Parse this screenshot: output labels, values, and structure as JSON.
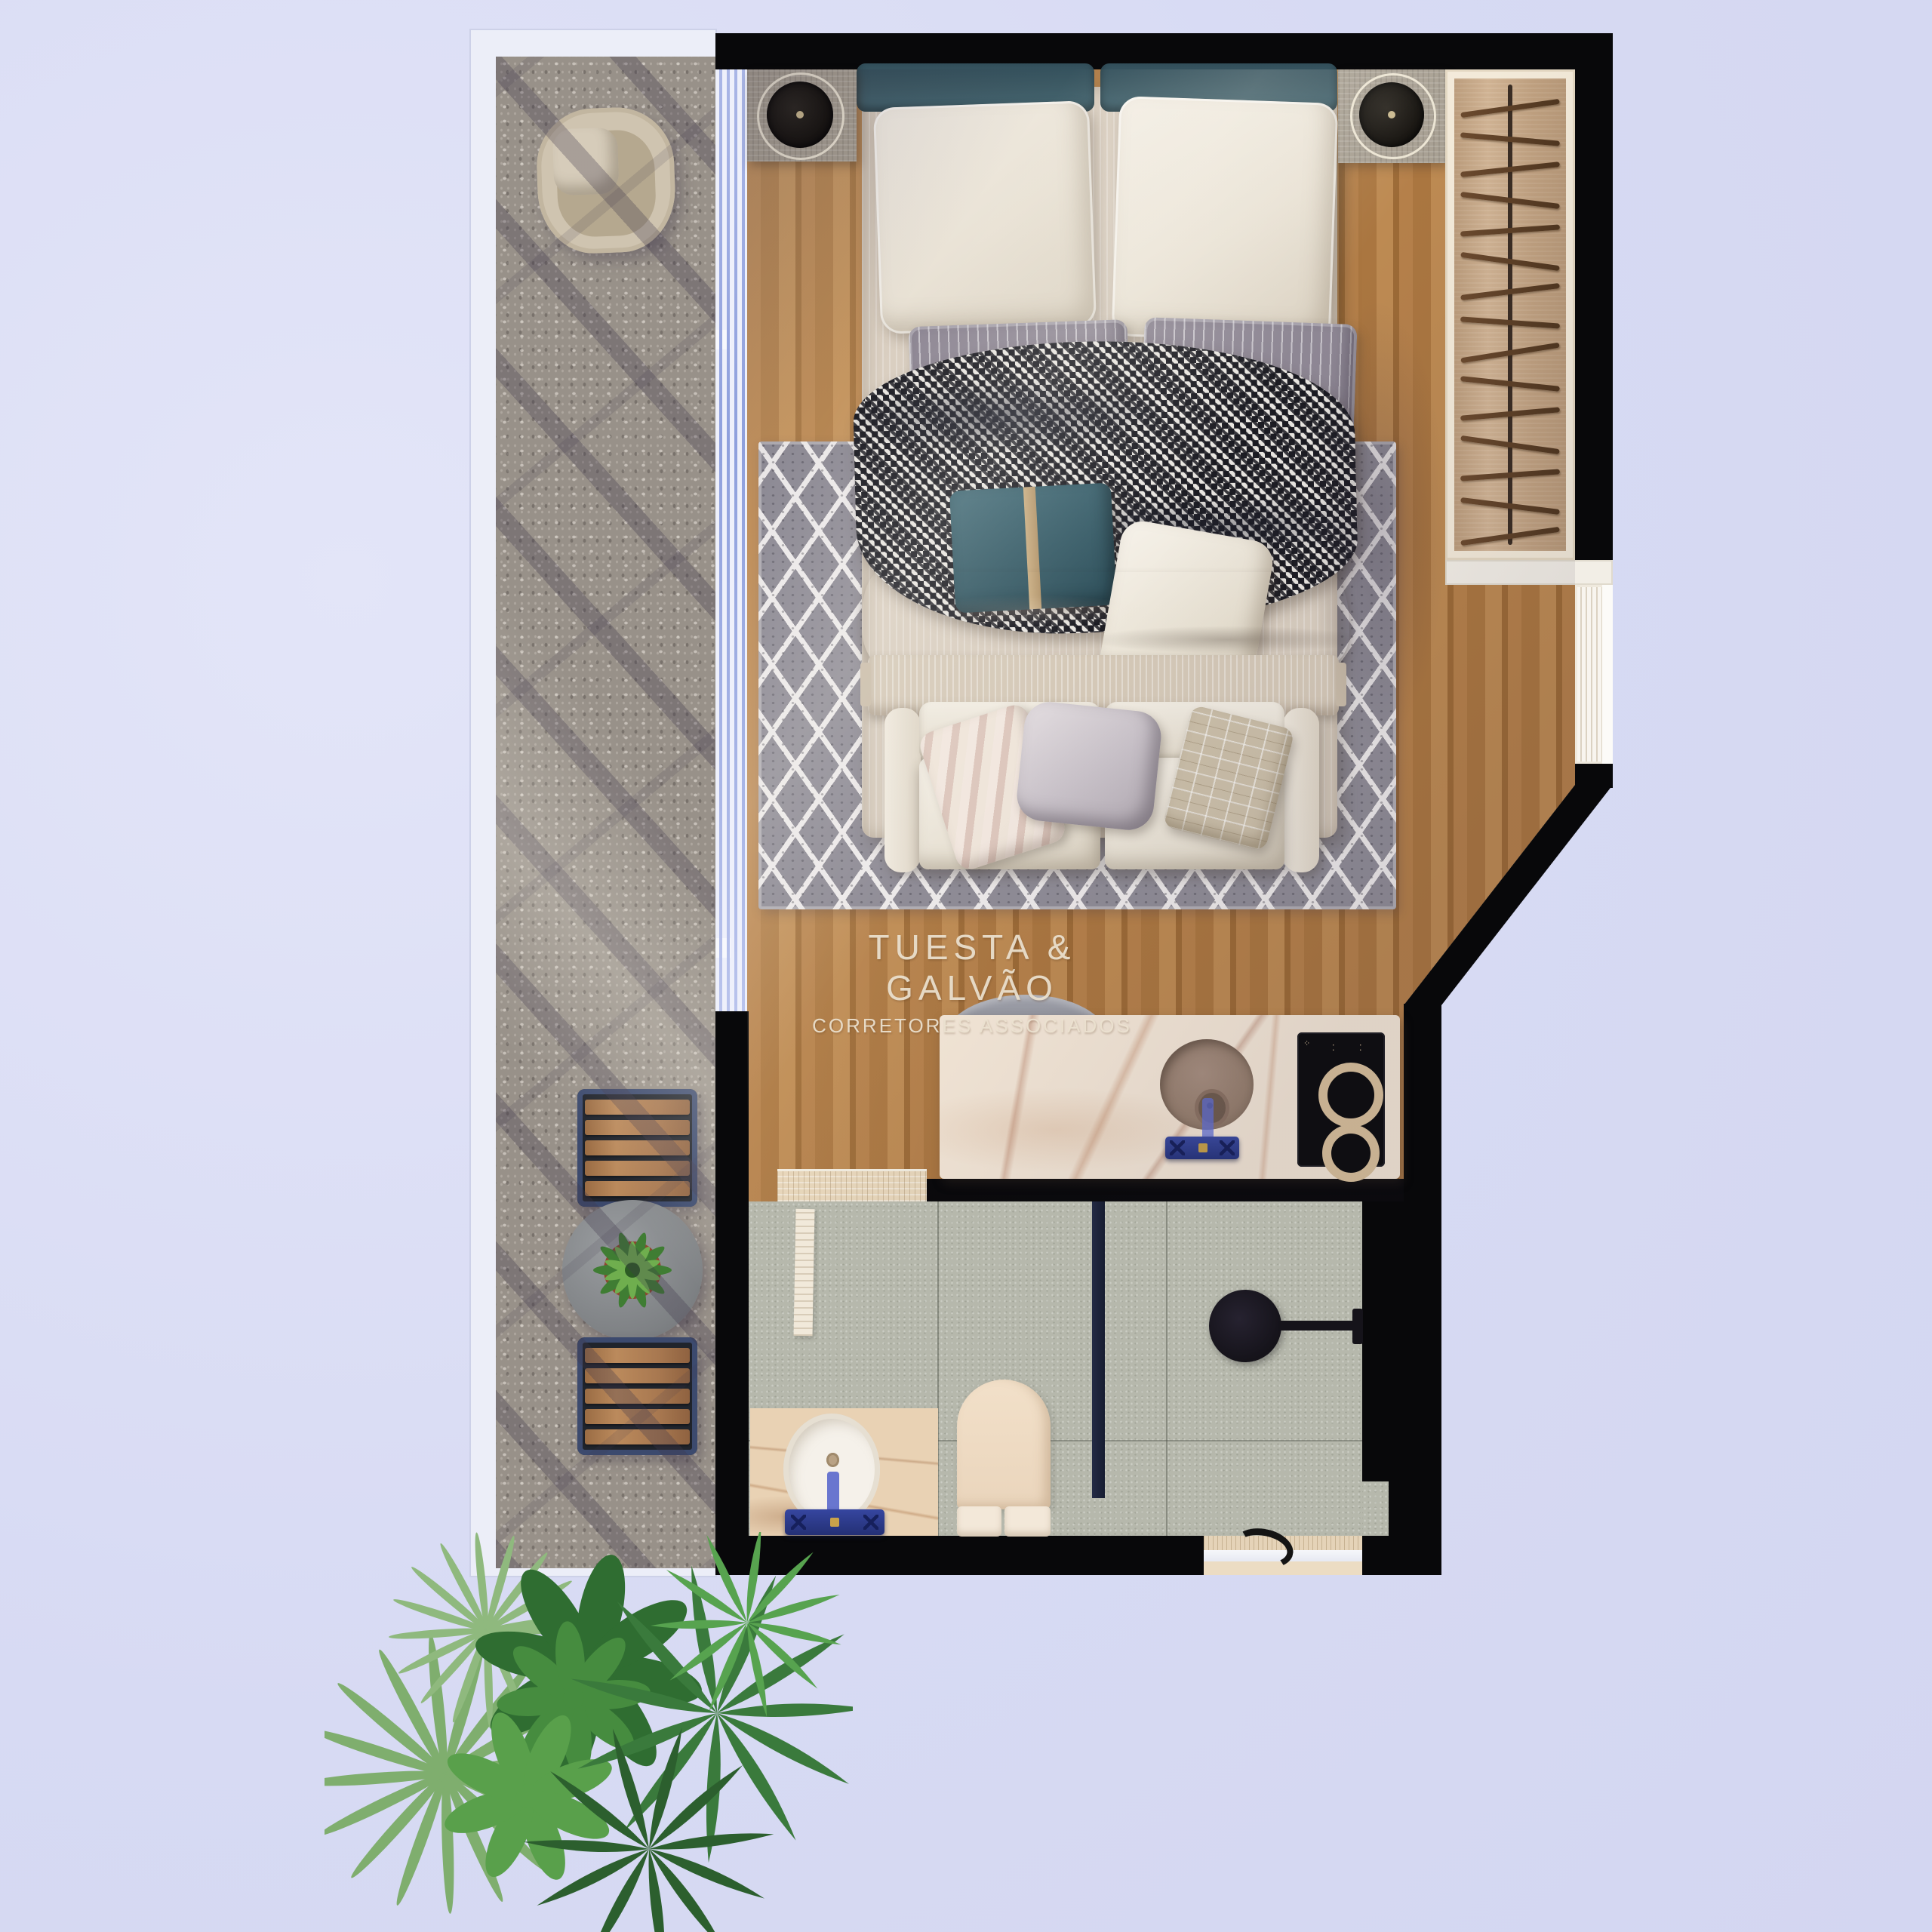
{
  "watermark": {
    "line1": "TUESTA & GALVÃO",
    "line2": "CORRETORES ASSOCIADOS"
  },
  "palette": {
    "background": "#d7daf3",
    "wall_black": "#08080a",
    "wood_floor": "#b07a42",
    "balcony_stone": "#989189",
    "bathroom_tile": "#b6b8ac",
    "rug_gray": "#8f8c96",
    "counter_marble": "#f4e7d7",
    "vanity_marble": "#e9d2b4",
    "headboard_teal": "#3d5a64",
    "faucet_navy": "#2c3a86",
    "glass_blue": "#9fb0de",
    "closet_tan": "#c9aa89",
    "plant_green": "#3a7a3c"
  },
  "closet": {
    "hanger_count": 15
  },
  "glass_wall": {
    "panel_line_count": 4
  },
  "cooktop": {
    "burner_count": 2
  },
  "bistro": {
    "chair_count": 2,
    "chair_slat_count": 5
  }
}
